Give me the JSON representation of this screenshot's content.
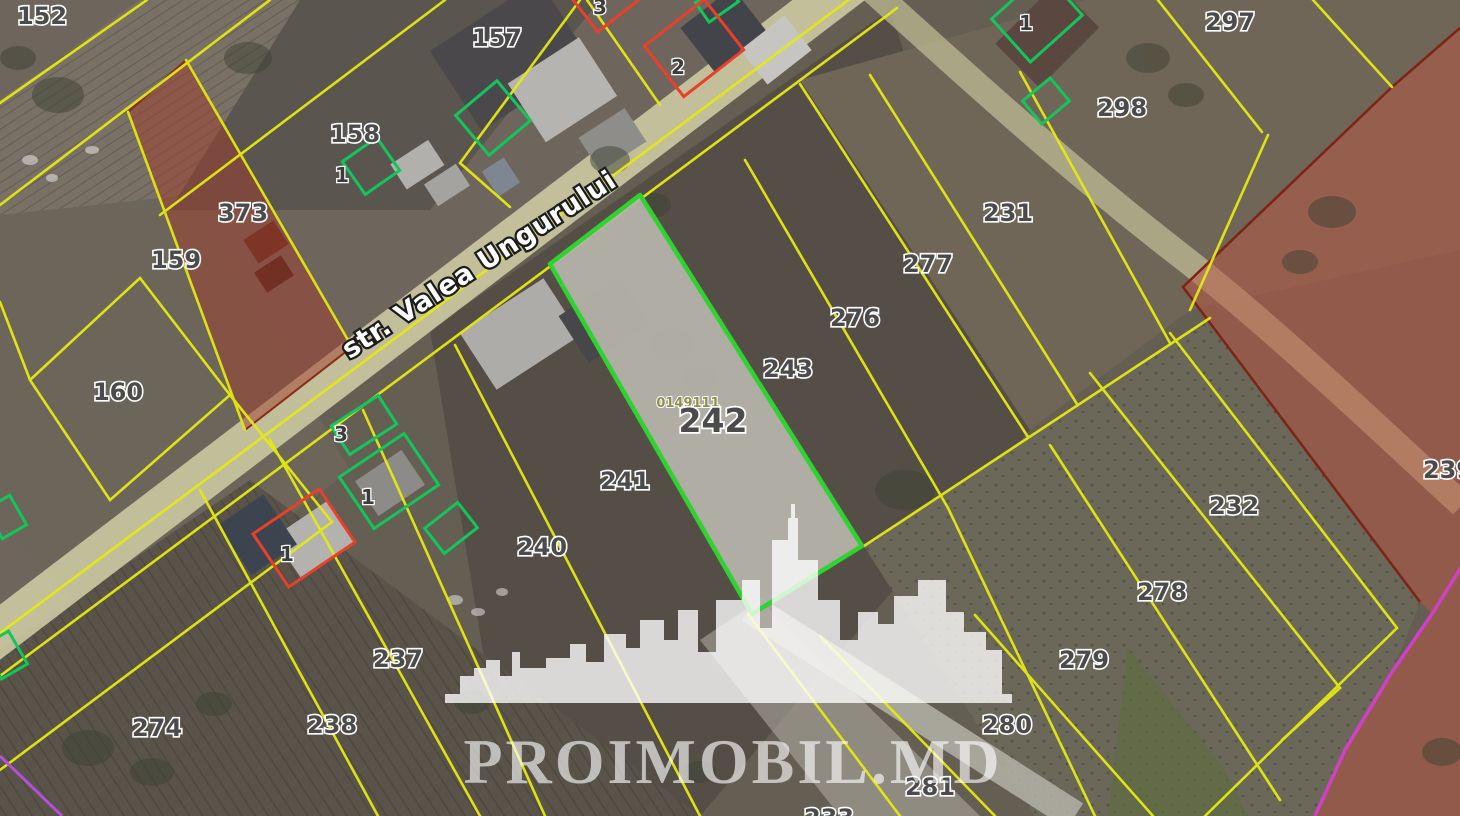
{
  "street": {
    "name": "str. Valea Ungurului"
  },
  "watermark": {
    "text": "PROIMOBIL.MD"
  },
  "highlight": {
    "parcel_number": "242",
    "cadastral_code": "0149111",
    "outline_color": "#2fd32f"
  },
  "parcels": {
    "n152": "152",
    "n157": "157",
    "n158": "158",
    "n159": "159",
    "n160": "160",
    "n373": "373",
    "n231": "231",
    "n232": "232",
    "n233": "233",
    "n237": "237",
    "n238": "238",
    "n239": "239",
    "n240": "240",
    "n241": "241",
    "n242": "242",
    "n243": "243",
    "n274": "274",
    "n276": "276",
    "n277": "277",
    "n278": "278",
    "n279": "279",
    "n280": "280",
    "n281": "281",
    "n297": "297",
    "n298": "298"
  },
  "building_marks": {
    "top_red": "3",
    "red_house_ne": "2",
    "green_158": "1",
    "green_corner_ne": "1",
    "green_mid": "3",
    "green_mid_house": "1",
    "red_house_s": "1"
  },
  "colors": {
    "parcel_line": "#e4ea12",
    "building_green": "#14c55c",
    "building_red": "#e8402a",
    "restricted_red_fill": "#a8503c",
    "restricted_red_line": "#7e2414",
    "boundary_magenta": "#d040c8",
    "road_fill": "#c9c7a0",
    "highlight_fill": "#b5b2aa"
  }
}
